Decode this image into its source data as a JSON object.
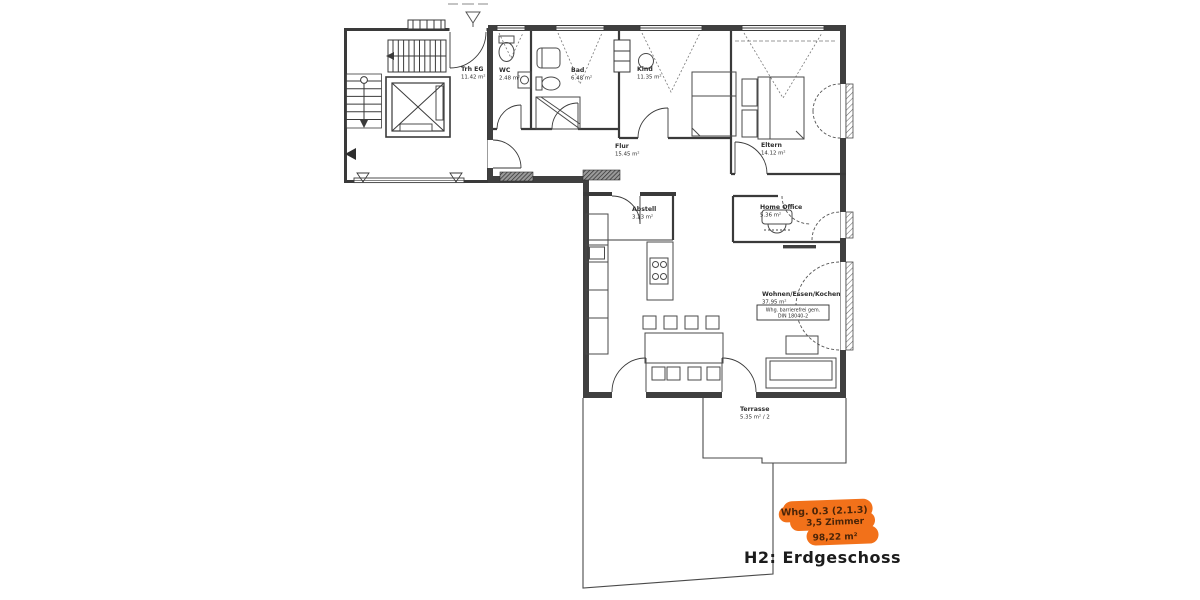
{
  "title": "H2: Erdgeschoss",
  "accent_color": "#f2711a",
  "unit_tag": {
    "line1": "Whg. 0.3 (2.1.3)",
    "line2": "3,5 Zimmer",
    "line3": "98,22 m²"
  },
  "note_box": {
    "line1": "Whg. barrierefrei gem.",
    "line2": "DIN 18040-2"
  },
  "rooms": {
    "trh": {
      "name": "Trh EG",
      "area": "11.42 m²"
    },
    "wc": {
      "name": "WC",
      "area": "2.48 m²"
    },
    "bad": {
      "name": "Bad",
      "area": "6.48 m²"
    },
    "kind": {
      "name": "Kind",
      "area": "11.35 m²"
    },
    "eltern": {
      "name": "Eltern",
      "area": "14.12 m²"
    },
    "flur": {
      "name": "Flur",
      "area": "15.45 m²"
    },
    "abstell": {
      "name": "Abstell",
      "area": "3.23 m²"
    },
    "home_office": {
      "name": "Home Office",
      "area": "5.36 m²"
    },
    "wohnen": {
      "name": "Wohnen/Essen/Kochen",
      "area": "37.95 m²"
    },
    "terrasse": {
      "name": "Terrasse",
      "area": "5.35 m² / 2"
    }
  }
}
